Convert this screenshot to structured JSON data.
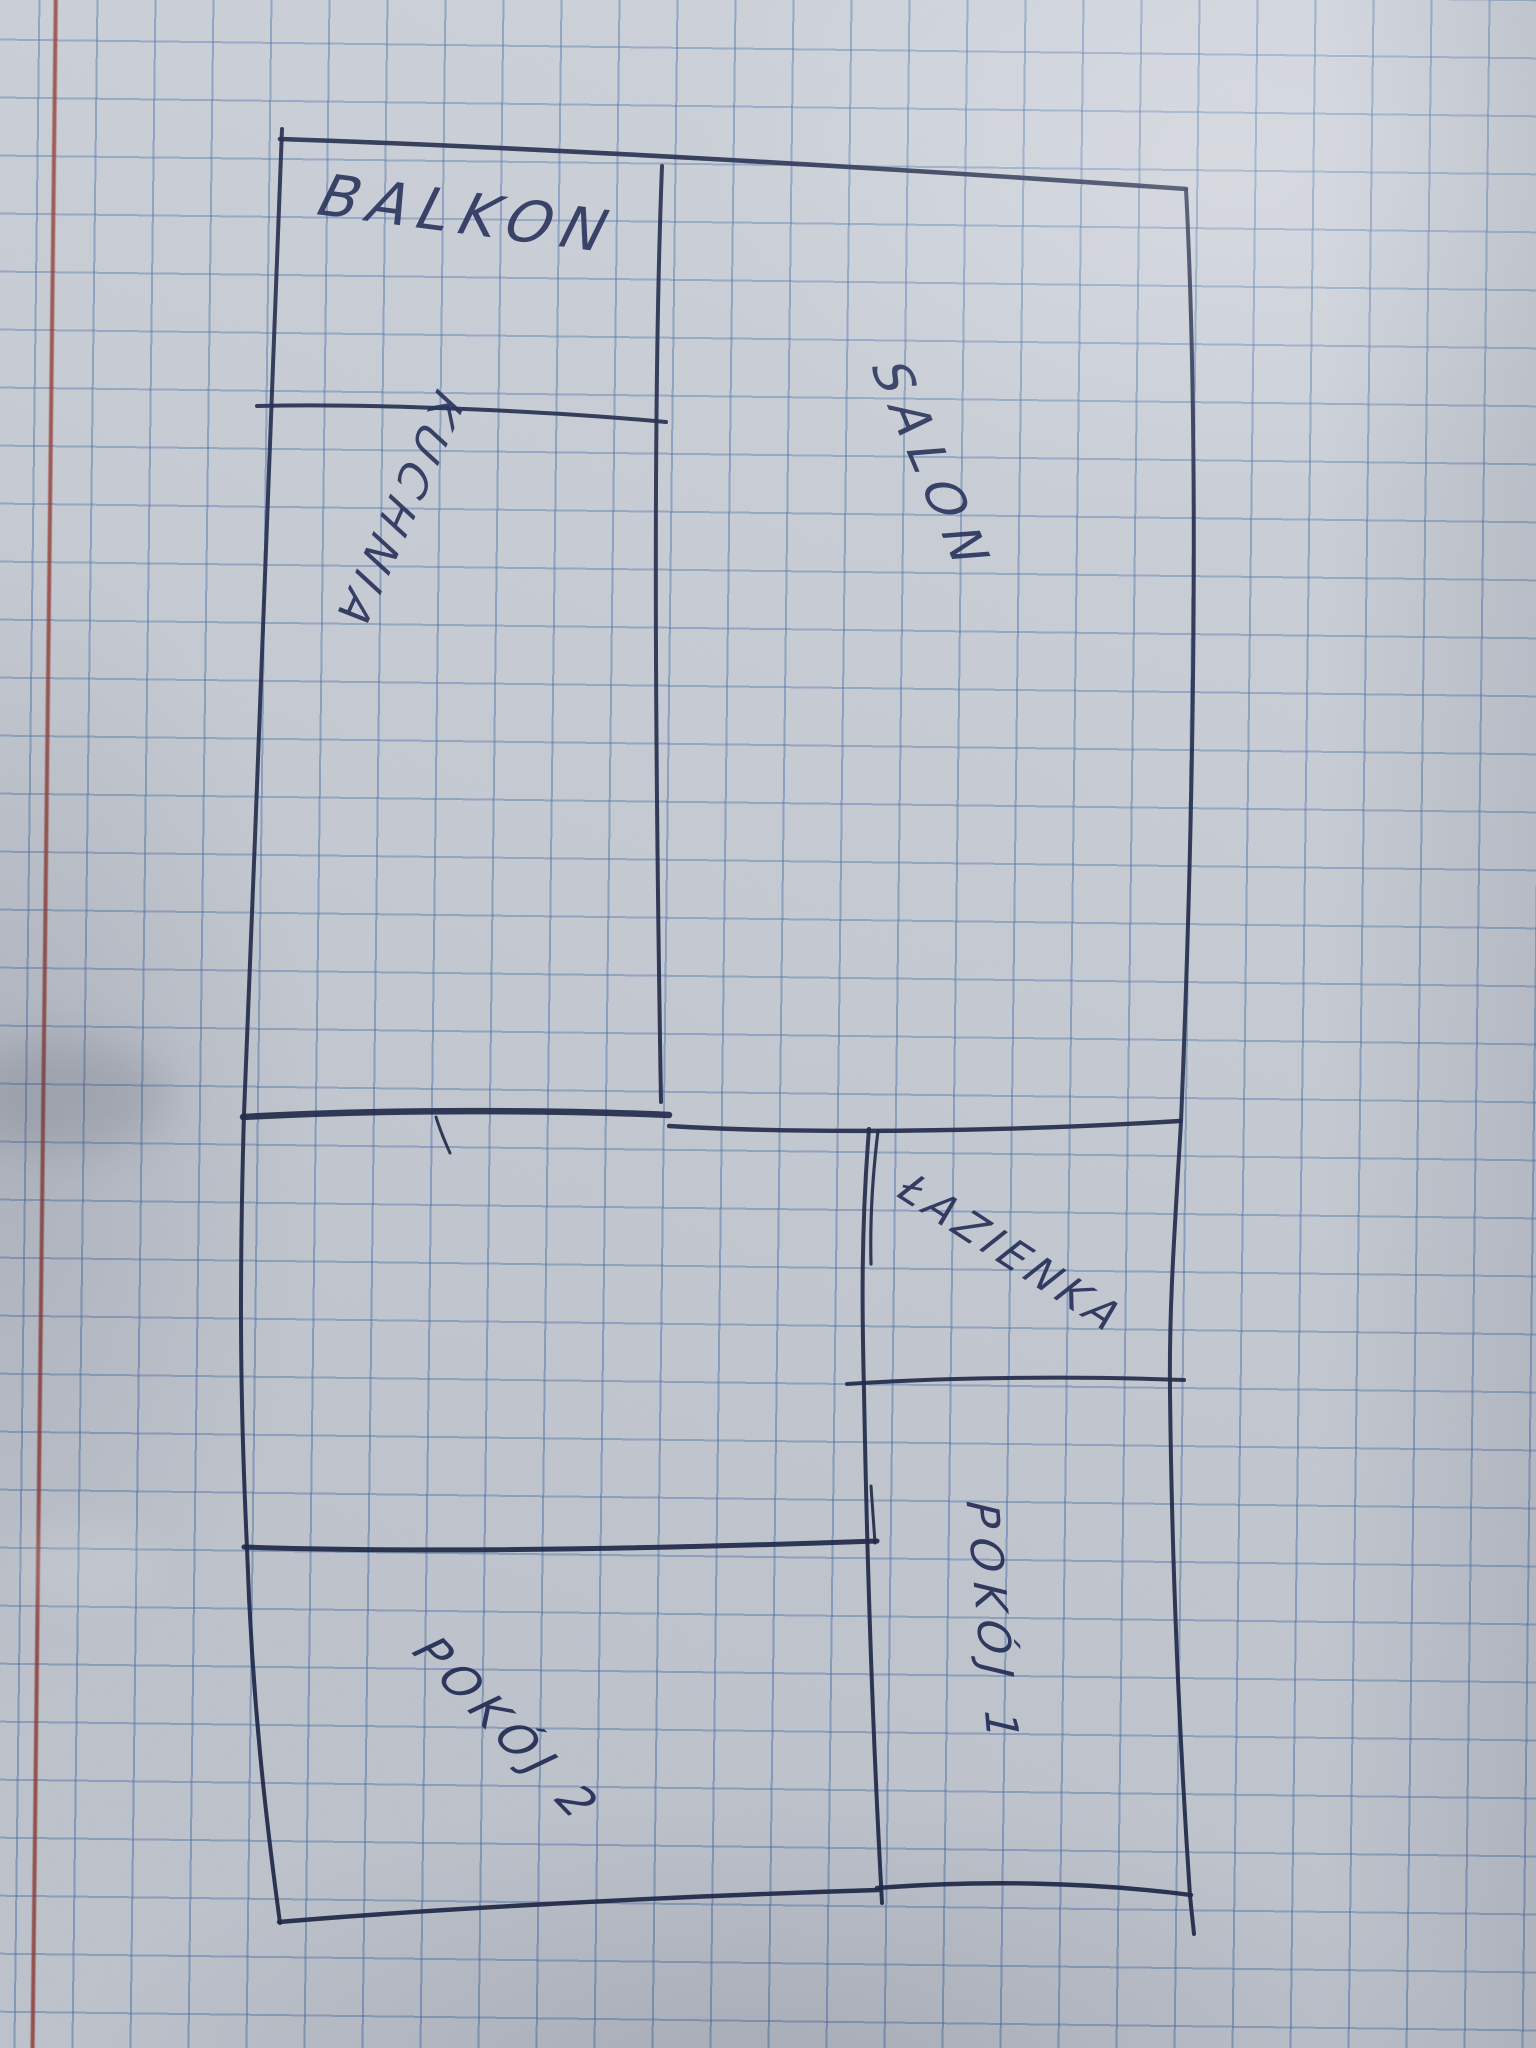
{
  "floor_plan": {
    "title": "Hand-drawn apartment floor plan on squared notebook paper",
    "language": "Polish",
    "rooms": [
      {
        "id": "balkon",
        "label": "BALKON"
      },
      {
        "id": "kuchnia",
        "label": "KUCHNIA"
      },
      {
        "id": "salon",
        "label": "SALON"
      },
      {
        "id": "lazienka",
        "label": "ŁAZIENKA"
      },
      {
        "id": "pokoj-1",
        "label": "POKÓJ 1"
      },
      {
        "id": "pokoj-2",
        "label": "POKÓJ 2"
      }
    ]
  },
  "colors": {
    "ink": "#1e2848",
    "grid_line": "#4870ac",
    "paper": "#cbd0d8",
    "margin_line": "#953a31"
  }
}
